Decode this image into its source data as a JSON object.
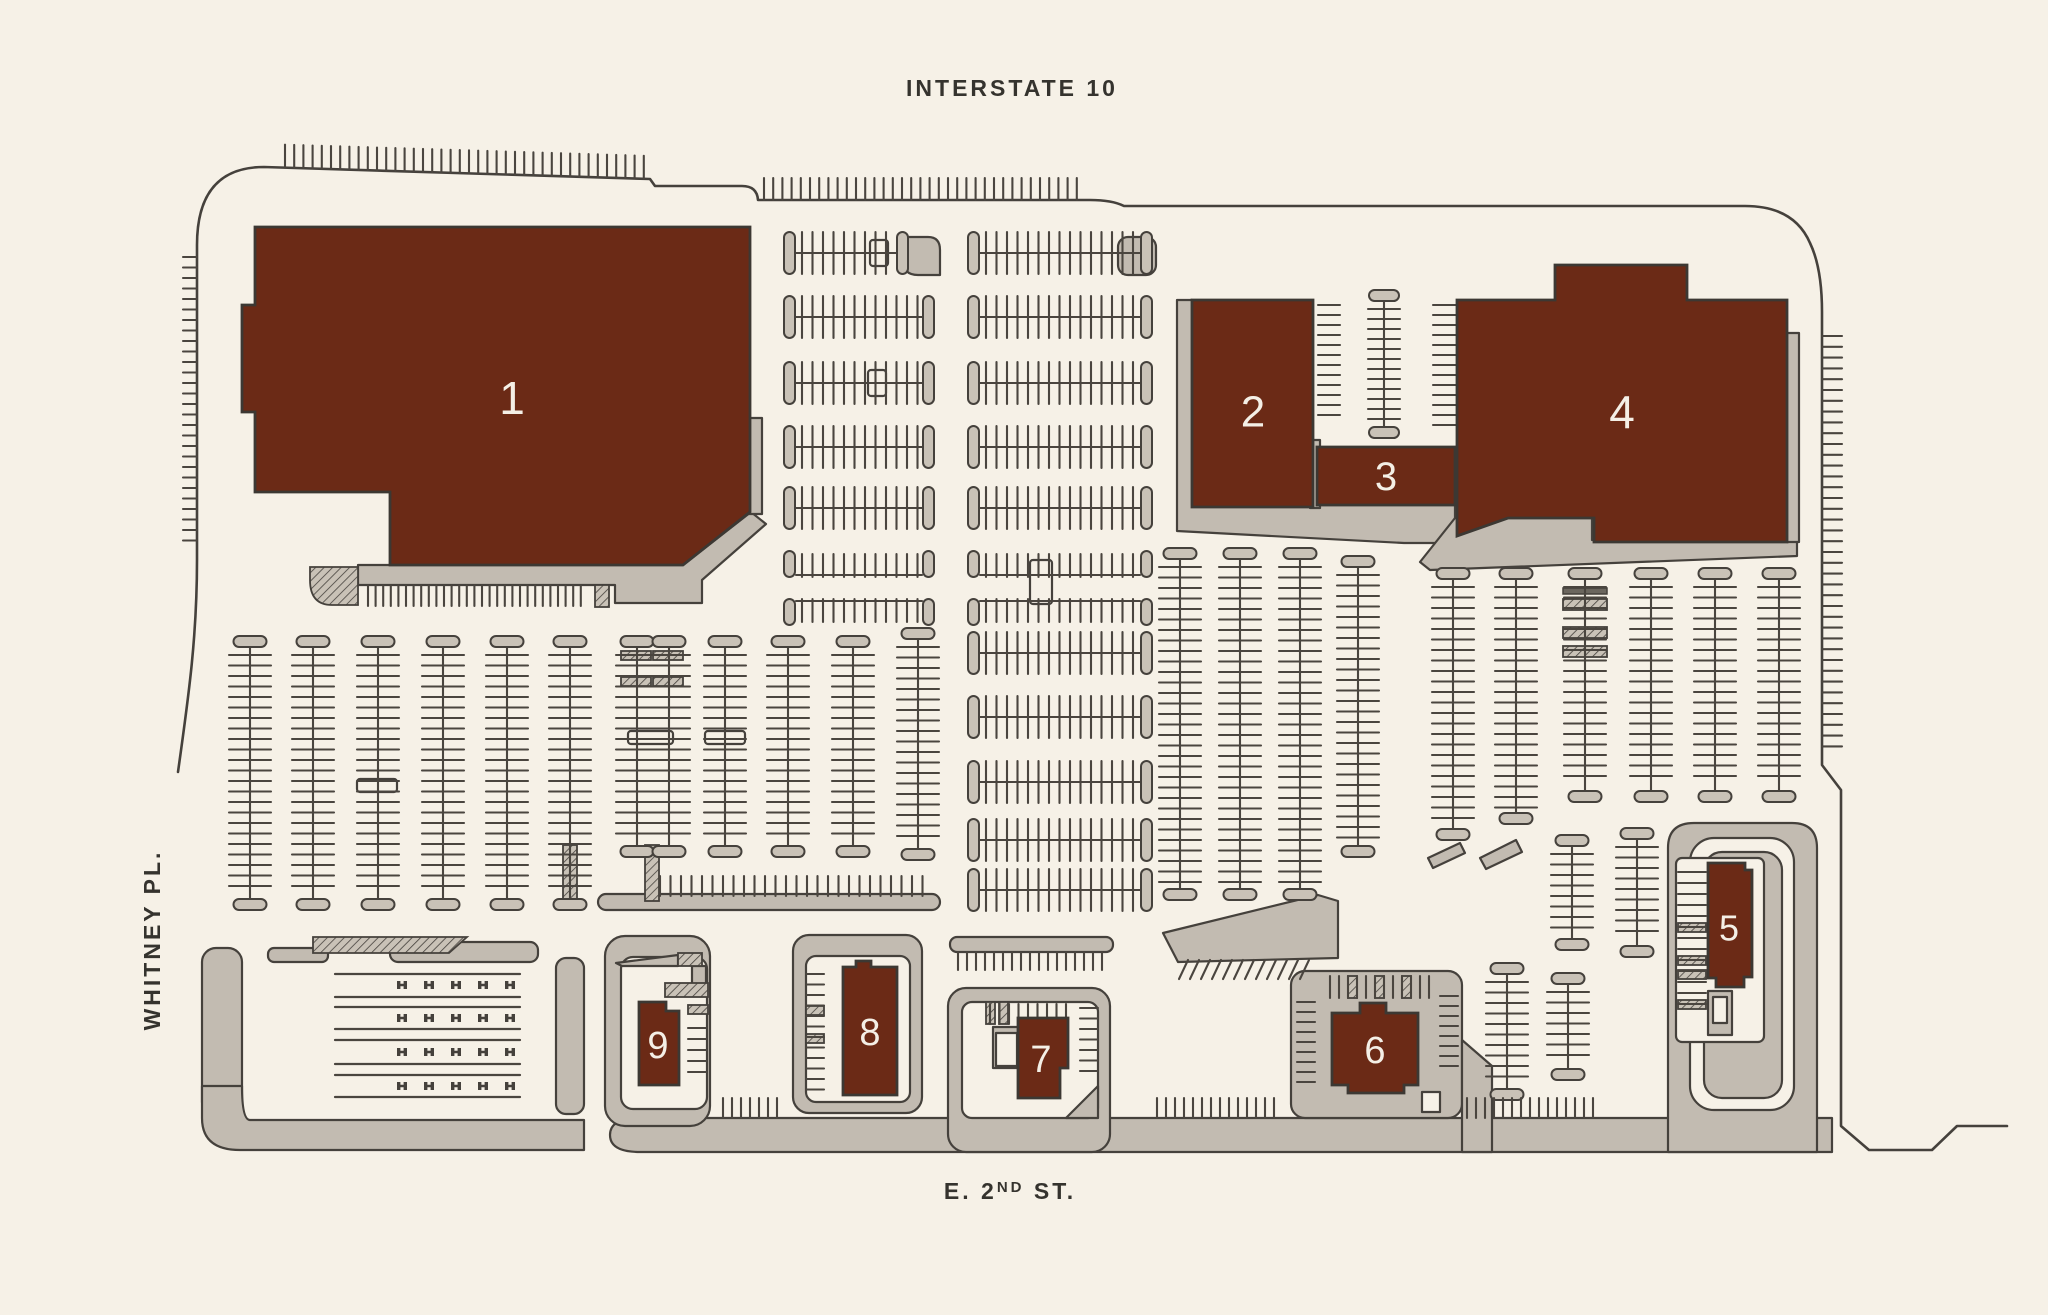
{
  "streets": {
    "top": "INTERSTATE 10",
    "left": "WHITNEY PL.",
    "bottom": {
      "prefix": "E. 2",
      "superscript": "ND",
      "suffix": " ST."
    }
  },
  "buildings": [
    {
      "label": "1"
    },
    {
      "label": "2"
    },
    {
      "label": "3"
    },
    {
      "label": "4"
    },
    {
      "label": "5"
    },
    {
      "label": "6"
    },
    {
      "label": "7"
    },
    {
      "label": "8"
    },
    {
      "label": "9"
    }
  ],
  "colors": {
    "background": "#f6f1e7",
    "building": "#6b2a16",
    "pavement": "#c2bbb1",
    "outline": "#45413c",
    "building_label": "#f4efe6",
    "street_label": "#35332e"
  }
}
